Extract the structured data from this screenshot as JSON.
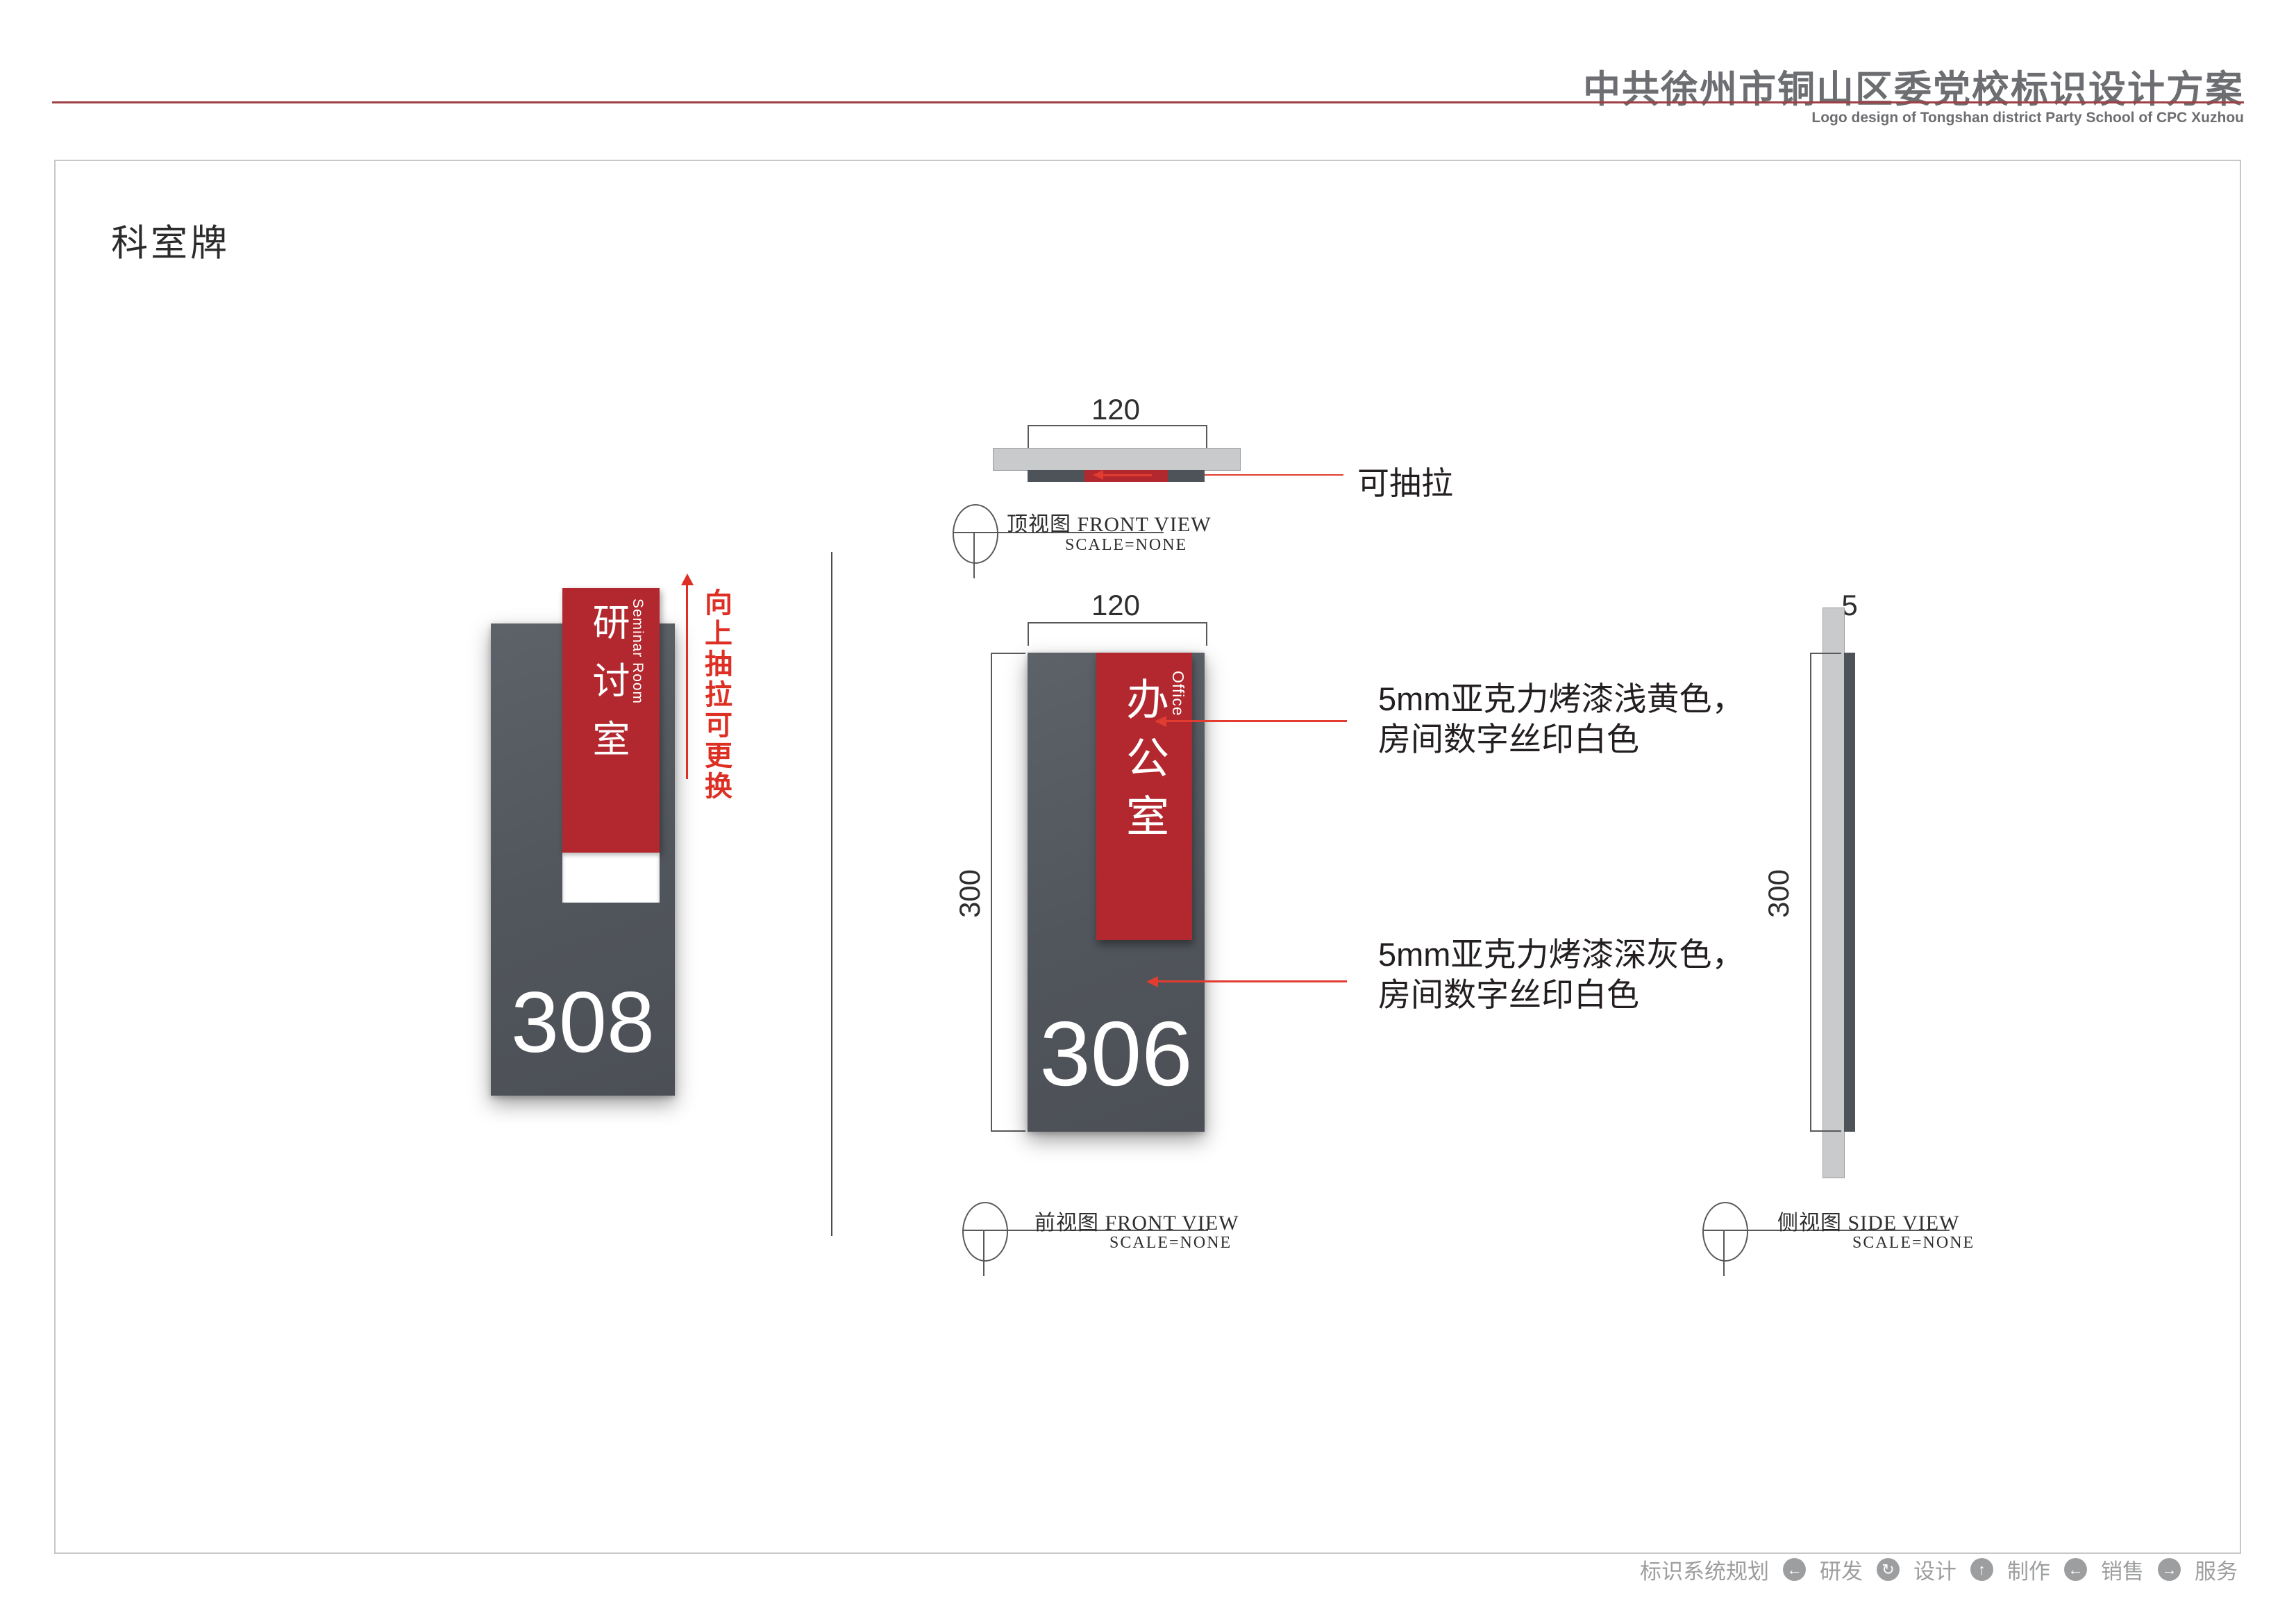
{
  "header": {
    "title": "中共徐州市铜山区委党校标识设计方案",
    "subtitle": "Logo design of Tongshan district Party School of CPC Xuzhou"
  },
  "section_title": "科室牌",
  "sign_render": {
    "name_cn": "研讨室",
    "name_en": "Seminar Room",
    "number": "308",
    "pull_note": "向上抽拉可更换"
  },
  "views": {
    "top": {
      "width_dim": "120",
      "callout": "可抽拉",
      "label_cn": "顶视图",
      "label_en": "FRONT VIEW",
      "scale": "SCALE=NONE"
    },
    "front": {
      "width_dim": "120",
      "height_dim": "300",
      "name_cn": "办公室",
      "name_en": "Office",
      "number": "306",
      "note_insert_l1": "5mm亚克力烤漆浅黄色，",
      "note_insert_l2": "房间数字丝印白色",
      "note_panel_l1": "5mm亚克力烤漆深灰色，",
      "note_panel_l2": "房间数字丝印白色",
      "label_cn": "前视图",
      "label_en": "FRONT VIEW",
      "scale": "SCALE=NONE"
    },
    "side": {
      "thickness_dim": "5",
      "height_dim": "300",
      "label_cn": "侧视图",
      "label_en": "SIDE VIEW",
      "scale": "SCALE=NONE"
    }
  },
  "footer": {
    "items": [
      "标识系统规划",
      "研发",
      "设计",
      "制作",
      "销售",
      "服务"
    ],
    "icons": [
      "←",
      "↻",
      "↑",
      "←",
      "→"
    ]
  },
  "colors": {
    "sign_red": "#b2282e",
    "panel_gray": "#545a61",
    "annotation_red": "#dd2f23",
    "leader_red": "#e23c30",
    "light_gray_bar": "#c9cacb",
    "header_gray": "#6d6e71",
    "header_rule_red": "#9e4045",
    "footer_gray": "#9d9e9f"
  }
}
